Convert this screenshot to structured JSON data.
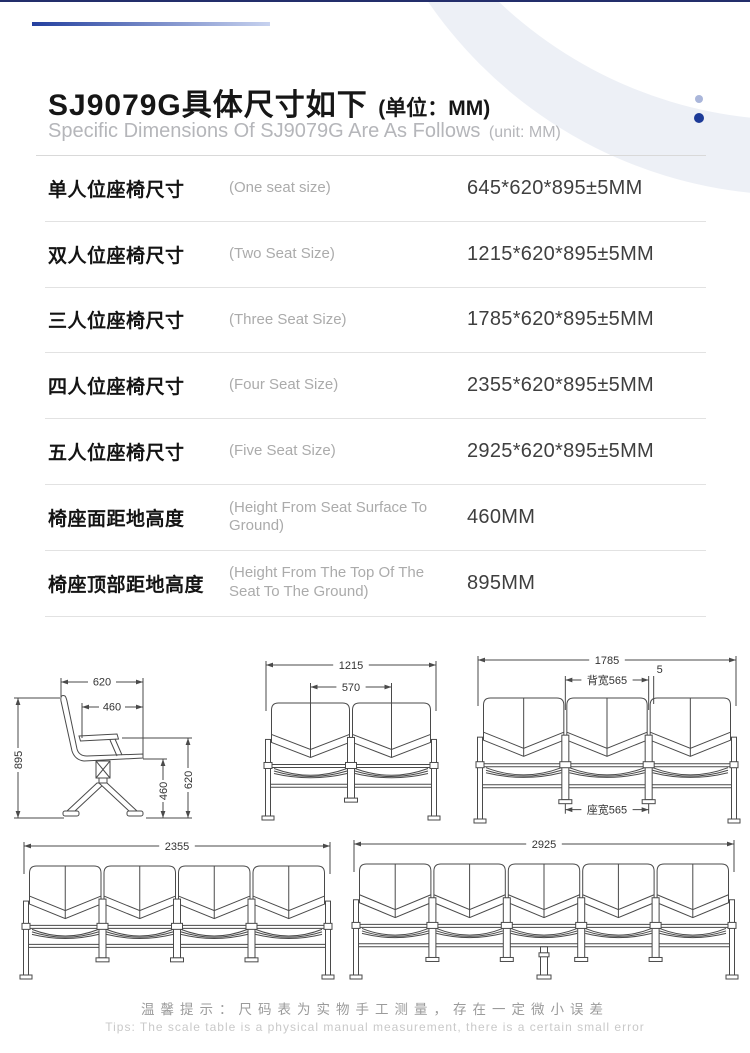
{
  "header": {
    "title_cn": "SJ9079G具体尺寸如下",
    "title_unit": "(单位：MM)",
    "subtitle_en": "Specific Dimensions Of SJ9079G Are As Follows",
    "subtitle_unit": "(unit: MM)"
  },
  "table": {
    "rows": [
      {
        "label_cn": "单人位座椅尺寸",
        "label_en": "(One seat size)",
        "value": "645*620*895±5MM"
      },
      {
        "label_cn": "双人位座椅尺寸",
        "label_en": "(Two Seat Size)",
        "value": "1215*620*895±5MM"
      },
      {
        "label_cn": "三人位座椅尺寸",
        "label_en": "(Three Seat Size)",
        "value": "1785*620*895±5MM"
      },
      {
        "label_cn": "四人位座椅尺寸",
        "label_en": "(Four Seat Size)",
        "value": "2355*620*895±5MM"
      },
      {
        "label_cn": "五人位座椅尺寸",
        "label_en": "(Five Seat Size)",
        "value": "2925*620*895±5MM"
      },
      {
        "label_cn": "椅座面距地高度",
        "label_en": "(Height From Seat Surface To Ground)",
        "value": "460MM"
      },
      {
        "label_cn": "椅座顶部距地高度",
        "label_en": "(Height From The Top Of The Seat To The Ground)",
        "value": "895MM"
      }
    ]
  },
  "diagrams": {
    "side_view": {
      "width_top": "620",
      "width_inner": "460",
      "height_total": "895",
      "height_seat": "460",
      "height_arm": "620"
    },
    "two_seat": {
      "overall": "1215",
      "seat_width": "570"
    },
    "three_seat": {
      "overall": "1785",
      "back_width_label": "背宽565",
      "gap": "5",
      "seat_width_label": "座宽565"
    },
    "four_seat": {
      "overall": "2355"
    },
    "five_seat": {
      "overall": "2925"
    }
  },
  "footer": {
    "tip_cn": "温馨提示：尺码表为实物手工测量，存在一定微小误差",
    "tip_en": "Tips: The scale table is a physical manual measurement, there is a certain small error"
  },
  "colors": {
    "accent_dark_blue": "#1c3a97",
    "accent_light_blue": "#aab6da",
    "gradient_line_start": "#24409f",
    "gradient_line_end": "#c7d2ef",
    "drawing_stroke": "#4a4a4a"
  }
}
